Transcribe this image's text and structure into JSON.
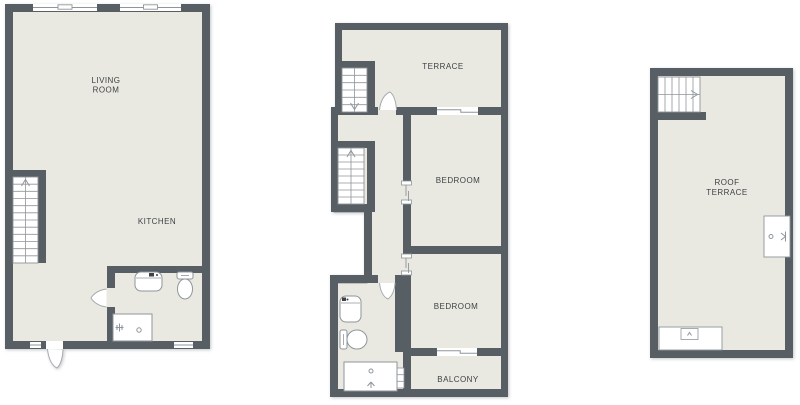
{
  "title": "apartment-floor-plans",
  "colors": {
    "wall": "#575E64",
    "floor": "#E9E9E1",
    "line": "#8F959A",
    "lightline": "#A6ABAF",
    "text": "#3E4245",
    "white": "#FFFFFF"
  },
  "plans": [
    {
      "name": "floor-plan-ground",
      "shapes": [
        {
          "t": "rect",
          "name": "floor",
          "x": 7,
          "y": 6,
          "w": 201,
          "h": 341,
          "f": "floor"
        },
        {
          "t": "rect",
          "name": "wall-top",
          "x": 5,
          "y": 4,
          "w": 205,
          "h": 8,
          "f": "wall"
        },
        {
          "t": "rect",
          "name": "wall-left",
          "x": 5,
          "y": 4,
          "w": 8,
          "h": 345,
          "f": "wall"
        },
        {
          "t": "rect",
          "name": "wall-right",
          "x": 202,
          "y": 4,
          "w": 8,
          "h": 345,
          "f": "wall"
        },
        {
          "t": "rect",
          "name": "wall-bottom",
          "x": 5,
          "y": 341,
          "w": 205,
          "h": 8,
          "f": "wall"
        },
        {
          "t": "rect",
          "name": "wall-stair-top",
          "x": 5,
          "y": 170,
          "w": 41,
          "h": 7,
          "f": "wall"
        },
        {
          "t": "rect",
          "name": "wall-stair-right",
          "x": 38,
          "y": 170,
          "w": 8,
          "h": 93,
          "f": "wall"
        },
        {
          "t": "rect",
          "name": "wall-bath-horizontal",
          "x": 107,
          "y": 266,
          "w": 103,
          "h": 7,
          "f": "wall"
        },
        {
          "t": "rect",
          "name": "wall-bath-vertical",
          "x": 107,
          "y": 266,
          "w": 8,
          "h": 75,
          "f": "wall"
        },
        {
          "t": "window",
          "name": "window",
          "x": 33,
          "y": 4,
          "w": 64,
          "h": 7,
          "style": "notch"
        },
        {
          "t": "window",
          "name": "window",
          "x": 120,
          "y": 4,
          "w": 61,
          "h": 7,
          "style": "notch"
        },
        {
          "t": "window",
          "name": "window",
          "x": 30,
          "y": 342,
          "w": 11,
          "h": 6,
          "style": "plain"
        },
        {
          "t": "window",
          "name": "window",
          "x": 174,
          "y": 342,
          "w": 19,
          "h": 6,
          "style": "plain"
        },
        {
          "t": "rect",
          "name": "door-opening",
          "x": 46,
          "y": 341,
          "w": 17,
          "h": 8,
          "f": "white"
        },
        {
          "t": "path",
          "name": "entry-door-leaf",
          "d": "M 47.5 349 C 48.5 359.5 52.5 366 57 368 C 61 364.5 62.8 356.5 63 349.5",
          "f": "white",
          "s": "lightline"
        },
        {
          "t": "rect",
          "name": "door-opening",
          "x": 107,
          "y": 288,
          "w": 8,
          "h": 19,
          "f": "floor"
        },
        {
          "t": "path",
          "name": "bath-door-leaf",
          "d": "M 106.5 289 C 98 290 93 294.5 91 298 C 93 301.5 98 306 106.5 307",
          "f": "white",
          "s": "lightline"
        },
        {
          "t": "stairs",
          "name": "staircase",
          "x": 13,
          "y": 177,
          "w": 25,
          "h": 86,
          "steps": 12,
          "dir": "v",
          "arrow": "up"
        },
        {
          "t": "rect",
          "name": "sink",
          "x": 135,
          "y": 272,
          "w": 27,
          "h": 19,
          "rx": 6,
          "f": "white",
          "s": "line"
        },
        {
          "t": "line",
          "name": "sink-detail",
          "x1": 136,
          "y1": 278,
          "x2": 161,
          "y2": 278,
          "s": "line",
          "sw": 0.8
        },
        {
          "t": "rect",
          "name": "sink-faucet-icon",
          "x": 149,
          "y": 273,
          "w": 5,
          "h": 3.5,
          "f": "text"
        },
        {
          "t": "circle",
          "name": "sink-faucet-dot",
          "cx": 157,
          "cy": 275,
          "r": 1,
          "f": "text"
        },
        {
          "t": "rect",
          "name": "toilet-tank",
          "x": 177,
          "y": 272,
          "w": 16,
          "h": 7,
          "rx": 2,
          "f": "white",
          "s": "line"
        },
        {
          "t": "ellipse",
          "name": "toilet-bowl",
          "cx": 185,
          "cy": 289,
          "rx": 7.5,
          "ry": 10,
          "f": "white",
          "s": "line"
        },
        {
          "t": "line",
          "name": "toilet-detail",
          "x1": 181,
          "y1": 275.5,
          "x2": 189,
          "y2": 275.5,
          "s": "line",
          "sw": 0.8
        },
        {
          "t": "rect",
          "name": "shower-tub",
          "x": 113,
          "y": 314,
          "w": 39,
          "h": 27,
          "f": "white",
          "s": "line"
        },
        {
          "t": "circle",
          "name": "drain",
          "cx": 139,
          "cy": 330,
          "r": 2.2,
          "f": "none",
          "s": "line"
        },
        {
          "t": "path",
          "name": "shower-head-icon",
          "d": "M 117 325 L 117 330 M 119.5 323.5 L 119.5 331.5 M 122 325 L 122 330 M 115.5 327.5 L 123.5 327.5",
          "s": "line"
        },
        {
          "t": "text",
          "name": "room-label-living-room",
          "x": 106,
          "y": 83,
          "lines": [
            "LIVING",
            "ROOM"
          ],
          "lh": 9.5
        },
        {
          "t": "text",
          "name": "room-label-kitchen",
          "x": 157,
          "y": 224,
          "text": "KITCHEN"
        }
      ]
    },
    {
      "name": "floor-plan-first",
      "shapes": [
        {
          "t": "rect",
          "name": "floor-terrace",
          "x": 338,
          "y": 26,
          "w": 164,
          "h": 84,
          "f": "floor"
        },
        {
          "t": "path",
          "name": "floor-main",
          "d": "M 334 110 H 504 V 393 H 334 V 283 H 367 V 212 H 334 Z",
          "f": "floor"
        },
        {
          "t": "rect",
          "name": "wall-terrace-top",
          "x": 335,
          "y": 23,
          "w": 173,
          "h": 7,
          "f": "wall"
        },
        {
          "t": "rect",
          "name": "wall-terrace-left",
          "x": 335,
          "y": 23,
          "w": 7,
          "h": 90,
          "f": "wall"
        },
        {
          "t": "rect",
          "name": "wall-right",
          "x": 501,
          "y": 23,
          "w": 7,
          "h": 374,
          "f": "wall"
        },
        {
          "t": "rect",
          "name": "wall-terrace-bottom",
          "x": 331,
          "y": 107,
          "w": 170,
          "h": 8,
          "f": "wall"
        },
        {
          "t": "rect",
          "name": "wall-left-upper",
          "x": 331,
          "y": 107,
          "w": 7,
          "h": 105,
          "f": "wall"
        },
        {
          "t": "rect",
          "name": "wall-step",
          "x": 331,
          "y": 204,
          "w": 41,
          "h": 8,
          "f": "wall"
        },
        {
          "t": "rect",
          "name": "wall-left-mid",
          "x": 364,
          "y": 204,
          "w": 8,
          "h": 79,
          "f": "wall"
        },
        {
          "t": "rect",
          "name": "wall-bath-top",
          "x": 330,
          "y": 275,
          "w": 48,
          "h": 8,
          "f": "wall"
        },
        {
          "t": "rect",
          "name": "wall-bath-right",
          "x": 395,
          "y": 275,
          "w": 16,
          "h": 77,
          "f": "wall"
        },
        {
          "t": "rect",
          "name": "wall-bath-left",
          "x": 330,
          "y": 275,
          "w": 8,
          "h": 122,
          "f": "wall"
        },
        {
          "t": "rect",
          "name": "wall-bottom",
          "x": 330,
          "y": 389,
          "w": 178,
          "h": 8,
          "f": "wall"
        },
        {
          "t": "rect",
          "name": "wall-hall-bedroom",
          "x": 403,
          "y": 107,
          "w": 8,
          "h": 245,
          "f": "wall"
        },
        {
          "t": "rect",
          "name": "wall-balcony-left",
          "x": 403,
          "y": 352,
          "w": 8,
          "h": 45,
          "f": "wall"
        },
        {
          "t": "rect",
          "name": "wall-bedroom-divider",
          "x": 403,
          "y": 246,
          "w": 105,
          "h": 8,
          "f": "wall"
        },
        {
          "t": "rect",
          "name": "wall-balcony-top",
          "x": 403,
          "y": 348,
          "w": 105,
          "h": 8,
          "f": "wall"
        },
        {
          "t": "rect",
          "name": "wall-terrace-stair-top",
          "x": 338,
          "y": 61,
          "w": 37,
          "h": 7,
          "f": "wall"
        },
        {
          "t": "rect",
          "name": "wall-terrace-stair-right",
          "x": 367,
          "y": 61,
          "w": 8,
          "h": 54,
          "f": "wall"
        },
        {
          "t": "rect",
          "name": "wall-hall-stair-top",
          "x": 338,
          "y": 141,
          "w": 37,
          "h": 7,
          "f": "wall"
        },
        {
          "t": "rect",
          "name": "wall-hall-stair-right",
          "x": 367,
          "y": 141,
          "w": 8,
          "h": 71,
          "f": "wall"
        },
        {
          "t": "window",
          "name": "window",
          "x": 437,
          "y": 107,
          "w": 41,
          "h": 8,
          "style": "step"
        },
        {
          "t": "window",
          "name": "window",
          "x": 437,
          "y": 348,
          "w": 40,
          "h": 8,
          "style": "step"
        },
        {
          "t": "rect",
          "name": "door-opening",
          "x": 378,
          "y": 107,
          "w": 18,
          "h": 8,
          "f": "floor"
        },
        {
          "t": "path",
          "name": "terrace-door-leaf",
          "d": "M 379.5 110 C 380.5 100.5 384.5 94 390 92 C 394 95 396 102.5 396.5 110",
          "f": "white",
          "s": "lightline"
        },
        {
          "t": "rect",
          "name": "door-opening",
          "x": 378,
          "y": 275,
          "w": 17,
          "h": 8,
          "f": "floor"
        },
        {
          "t": "path",
          "name": "bath-door-leaf",
          "d": "M 379.5 283 C 380.5 291.5 383.5 297 388 299 C 392 296 394.5 290.5 395 283",
          "f": "white",
          "s": "lightline"
        },
        {
          "t": "rect",
          "name": "door-opening",
          "x": 403,
          "y": 183,
          "w": 8,
          "h": 19,
          "f": "floor"
        },
        {
          "t": "rect",
          "name": "door-jamb",
          "x": 401.5,
          "y": 181,
          "w": 10,
          "h": 4,
          "f": "white",
          "s": "line",
          "sw": 0.8
        },
        {
          "t": "rect",
          "name": "door-jamb",
          "x": 401.5,
          "y": 200,
          "w": 10,
          "h": 4,
          "f": "white",
          "s": "line",
          "sw": 0.8
        },
        {
          "t": "line",
          "name": "sliding-door-panel",
          "x1": 406,
          "y1": 185,
          "x2": 406,
          "y2": 196,
          "s": "line",
          "sw": 0.9
        },
        {
          "t": "line",
          "name": "sliding-door-panel",
          "x1": 408.5,
          "y1": 191,
          "x2": 408.5,
          "y2": 201,
          "s": "line",
          "sw": 0.9
        },
        {
          "t": "rect",
          "name": "door-opening",
          "x": 403,
          "y": 256,
          "w": 8,
          "h": 17,
          "f": "floor"
        },
        {
          "t": "rect",
          "name": "door-jamb",
          "x": 401.5,
          "y": 254,
          "w": 10,
          "h": 4,
          "f": "white",
          "s": "line",
          "sw": 0.8
        },
        {
          "t": "rect",
          "name": "door-jamb",
          "x": 401.5,
          "y": 271,
          "w": 10,
          "h": 4,
          "f": "white",
          "s": "line",
          "sw": 0.8
        },
        {
          "t": "line",
          "name": "sliding-door-panel",
          "x1": 406,
          "y1": 258,
          "x2": 406,
          "y2": 268,
          "s": "line",
          "sw": 0.9
        },
        {
          "t": "line",
          "name": "sliding-door-panel",
          "x1": 408.5,
          "y1": 263,
          "x2": 408.5,
          "y2": 273,
          "s": "line",
          "sw": 0.9
        },
        {
          "t": "stairs",
          "name": "staircase",
          "x": 342,
          "y": 68,
          "w": 25,
          "h": 44,
          "steps": 6,
          "dir": "v",
          "arrow": "down"
        },
        {
          "t": "stairs",
          "name": "staircase",
          "x": 338,
          "y": 148,
          "w": 26,
          "h": 56,
          "steps": 8,
          "dir": "v",
          "arrow": "up"
        },
        {
          "t": "rect",
          "name": "duct",
          "x": 396,
          "y": 368,
          "w": 8,
          "h": 20,
          "f": "white",
          "s": "line",
          "sw": 0.8
        },
        {
          "t": "line",
          "name": "duct-divider",
          "x1": 396,
          "y1": 374.7,
          "x2": 404,
          "y2": 374.7,
          "s": "line",
          "sw": 0.8
        },
        {
          "t": "line",
          "name": "duct-divider",
          "x1": 396,
          "y1": 381.3,
          "x2": 404,
          "y2": 381.3,
          "s": "line",
          "sw": 0.8
        },
        {
          "t": "rect",
          "name": "sink",
          "x": 340,
          "y": 296,
          "w": 21,
          "h": 26,
          "rx": 6,
          "f": "white",
          "s": "line"
        },
        {
          "t": "line",
          "name": "sink-detail",
          "x1": 341,
          "y1": 303,
          "x2": 360,
          "y2": 303,
          "s": "line",
          "sw": 0.8
        },
        {
          "t": "rect",
          "name": "sink-faucet-icon",
          "x": 342,
          "y": 297.5,
          "w": 4,
          "h": 3.5,
          "f": "text"
        },
        {
          "t": "circle",
          "name": "sink-faucet-dot",
          "cx": 347.5,
          "cy": 299.5,
          "r": 1,
          "f": "text"
        },
        {
          "t": "rect",
          "name": "toilet-tank",
          "x": 340,
          "y": 330,
          "w": 7,
          "h": 19,
          "rx": 2,
          "f": "white",
          "s": "line"
        },
        {
          "t": "ellipse",
          "name": "toilet-bowl",
          "cx": 357,
          "cy": 339.5,
          "rx": 10,
          "ry": 9.5,
          "f": "white",
          "s": "line"
        },
        {
          "t": "line",
          "name": "toilet-detail",
          "x1": 343.5,
          "y1": 334,
          "x2": 343.5,
          "y2": 345,
          "s": "line",
          "sw": 0.8
        },
        {
          "t": "rect",
          "name": "shower-tub",
          "x": 344,
          "y": 362,
          "w": 53,
          "h": 29,
          "f": "white",
          "s": "line"
        },
        {
          "t": "circle",
          "name": "drain",
          "cx": 371,
          "cy": 371,
          "r": 2,
          "f": "none",
          "s": "line"
        },
        {
          "t": "path",
          "name": "shower-head-icon",
          "d": "M 371 388 L 371 382 M 367.5 386 L 371 382 M 374.5 386 L 371 382",
          "s": "line"
        },
        {
          "t": "text",
          "name": "room-label-terrace",
          "x": 443,
          "y": 69,
          "text": "TERRACE"
        },
        {
          "t": "text",
          "name": "room-label-bedroom-1",
          "x": 458,
          "y": 183,
          "text": "BEDROOM"
        },
        {
          "t": "text",
          "name": "room-label-bedroom-2",
          "x": 456,
          "y": 309,
          "text": "BEDROOM"
        },
        {
          "t": "text",
          "name": "room-label-balcony",
          "x": 458,
          "y": 382,
          "text": "BALCONY"
        }
      ]
    },
    {
      "name": "floor-plan-roof",
      "shapes": [
        {
          "t": "rect",
          "name": "floor",
          "x": 654,
          "y": 72,
          "w": 135,
          "h": 282,
          "f": "floor"
        },
        {
          "t": "rect",
          "name": "wall-top",
          "x": 650,
          "y": 68,
          "w": 143,
          "h": 8,
          "f": "wall"
        },
        {
          "t": "rect",
          "name": "wall-left",
          "x": 650,
          "y": 68,
          "w": 8,
          "h": 290,
          "f": "wall"
        },
        {
          "t": "rect",
          "name": "wall-right",
          "x": 785,
          "y": 68,
          "w": 8,
          "h": 290,
          "f": "wall"
        },
        {
          "t": "rect",
          "name": "wall-bottom",
          "x": 650,
          "y": 350,
          "w": 143,
          "h": 8,
          "f": "wall"
        },
        {
          "t": "rect",
          "name": "wall-stair-bottom",
          "x": 658,
          "y": 112,
          "w": 48,
          "h": 8,
          "f": "wall"
        },
        {
          "t": "stairs",
          "name": "staircase",
          "x": 658,
          "y": 77,
          "w": 42,
          "h": 35,
          "steps": 6,
          "dir": "h",
          "arrow": "right"
        },
        {
          "t": "rect",
          "name": "utility-unit",
          "x": 764,
          "y": 216,
          "w": 26,
          "h": 41,
          "f": "white",
          "s": "line",
          "sw": 0.9
        },
        {
          "t": "circle",
          "name": "utility-dot",
          "cx": 771,
          "cy": 236.5,
          "r": 2,
          "f": "none",
          "s": "line"
        },
        {
          "t": "path",
          "name": "valve-icon",
          "d": "M 781 233 L 785.5 236.5 L 781 240 M 785.5 231.5 L 785.5 241.5",
          "s": "line"
        },
        {
          "t": "rect",
          "name": "planter",
          "x": 659,
          "y": 327,
          "w": 63,
          "h": 23,
          "f": "white",
          "s": "line",
          "sw": 0.9
        },
        {
          "t": "rect",
          "name": "planter-inner",
          "x": 681,
          "y": 328.5,
          "w": 17,
          "h": 11,
          "f": "white",
          "s": "line",
          "sw": 0.8
        },
        {
          "t": "path",
          "name": "planter-icon",
          "d": "M 687.5 335.5 L 689.5 332.5 L 691.5 335.5",
          "s": "line"
        },
        {
          "t": "text",
          "name": "room-label-roof-terrace",
          "x": 727,
          "y": 185,
          "lines": [
            "ROOF",
            "TERRACE"
          ],
          "lh": 10
        }
      ]
    }
  ]
}
